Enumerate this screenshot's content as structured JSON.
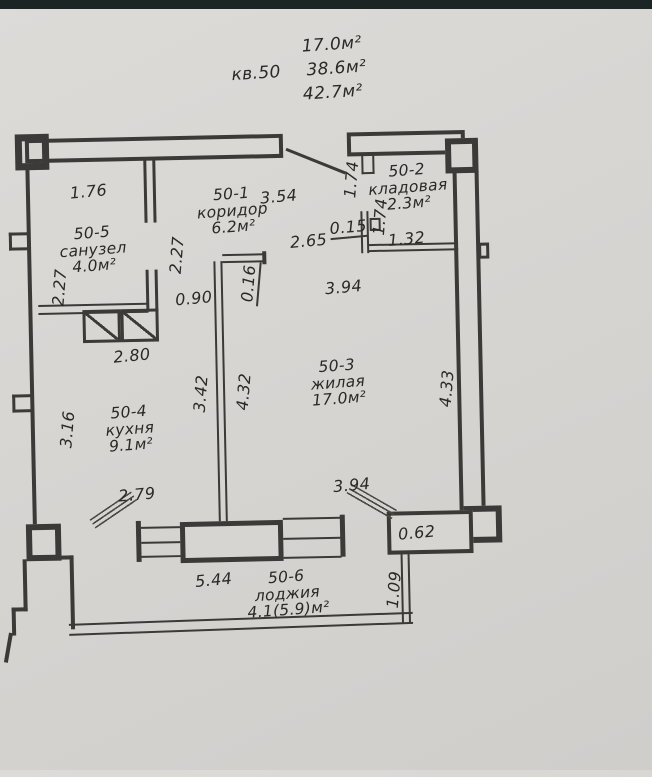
{
  "header": {
    "apartment_no": "кв.50",
    "area_living": "17.0м²",
    "area_main": "38.6м²",
    "area_total": "42.7м²"
  },
  "rooms": {
    "koridor": {
      "id": "50-1",
      "name": "коридор",
      "area": "6.2м²"
    },
    "kladovaya": {
      "id": "50-2",
      "name": "кладовая",
      "area": "2.3м²"
    },
    "zhilaya": {
      "id": "50-3",
      "name": "жилая",
      "area": "17.0м²"
    },
    "kuhnya": {
      "id": "50-4",
      "name": "кухня",
      "area": "9.1м²"
    },
    "sanuzel": {
      "id": "50-5",
      "name": "санузел",
      "area": "4.0м²"
    },
    "lodzhiya": {
      "id": "50-6",
      "name": "лоджия",
      "area": "4.1(5.9)м²"
    }
  },
  "dims": {
    "sanuzel_width": "1.76",
    "koridor_width": "3.54",
    "kladovaya_left_height": "1.74",
    "kladovaya_inner_height": "1.74",
    "kladovaya_wall_thickness": "0.15",
    "kladovaya_width": "1.32",
    "sanuzel_left_height": "2.27",
    "koridor_left_height": "2.27",
    "koridor_opening": "2.65",
    "kuhnya_door": "0.90",
    "partition_thickness": "0.16",
    "zhilaya_top_width": "3.94",
    "kuhnya_top_width": "2.80",
    "partition_kuhnya_side": "3.42",
    "partition_zhilaya_side": "4.32",
    "zhilaya_right_height": "4.33",
    "kuhnya_left_height": "3.16",
    "kuhnya_bottom_width": "2.79",
    "zhilaya_bottom_width": "3.94",
    "pier_width": "0.62",
    "lodzhiya_width": "5.44",
    "lodzhiya_depth": "1.09"
  },
  "colors": {
    "paper": "#d7d5d2",
    "ink": "#3b3a38",
    "text": "#2a2927",
    "scan_band": "#1b2523"
  }
}
